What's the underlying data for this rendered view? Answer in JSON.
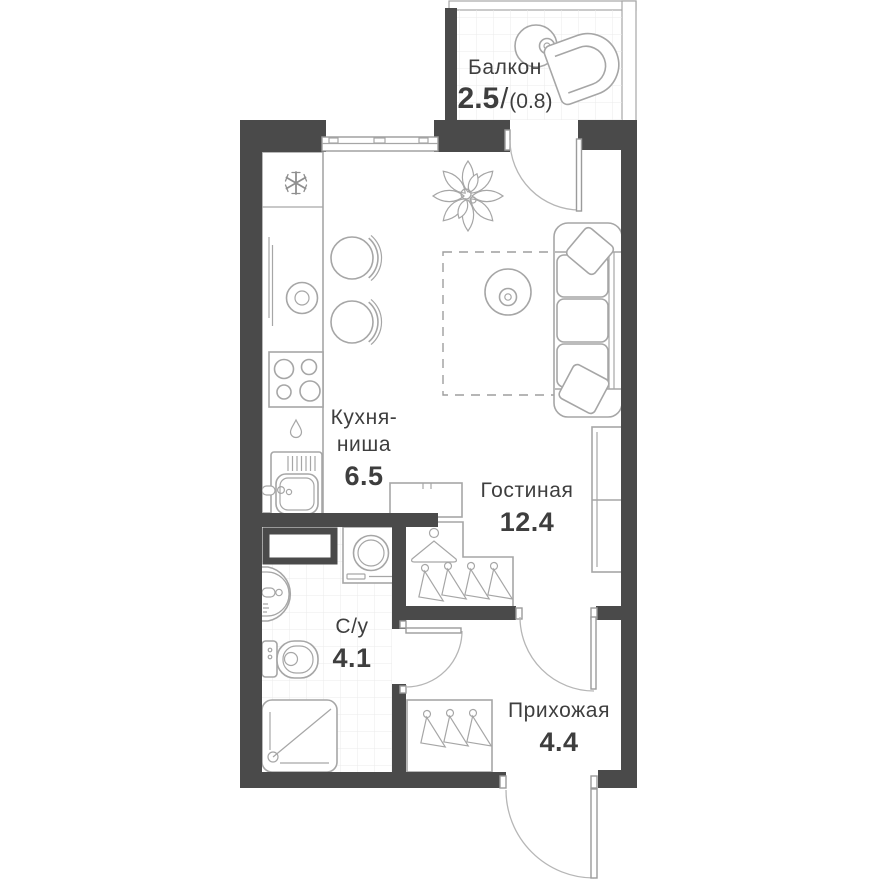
{
  "plan": {
    "rooms": {
      "balcony": {
        "name": "Балкон",
        "area_main": "2.5",
        "area_divider": "/",
        "area_secondary": "(0.8)"
      },
      "kitchen": {
        "name_line1": "Кухня-",
        "name_line2": "ниша",
        "area": "6.5"
      },
      "living": {
        "name": "Гостиная",
        "area": "12.4"
      },
      "bathroom": {
        "name": "С/у",
        "area": "4.1"
      },
      "hallway": {
        "name": "Прихожая",
        "area": "4.4"
      }
    },
    "colors": {
      "wall": "#4a4a4a",
      "furniture_line": "#a6a6a6",
      "text": "#3e3e3e",
      "tile_line": "#ebebeb",
      "door_line": "#9b9b9b",
      "dash_line": "#9e9e9e",
      "background": "#ffffff"
    }
  }
}
